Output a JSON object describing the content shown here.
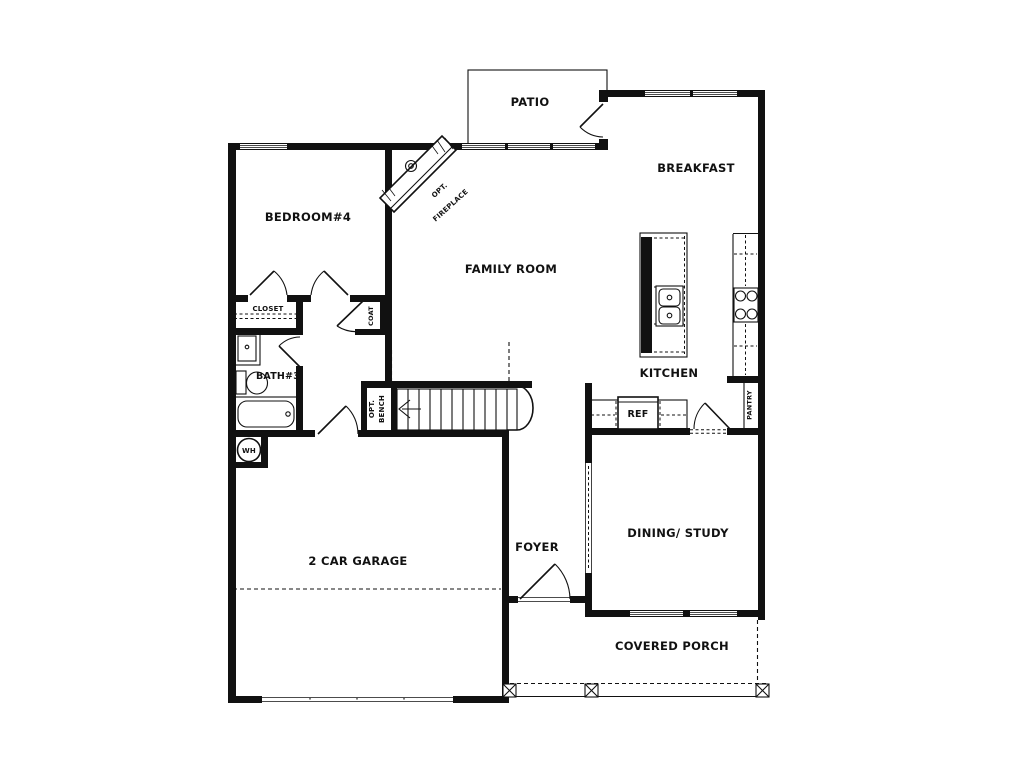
{
  "plan_title": "single-story house floor plan",
  "labels": {
    "patio": "PATIO",
    "breakfast": "BREAKFAST",
    "bedroom4": "BEDROOM#4",
    "family_room": "FAMILY ROOM",
    "kitchen": "KITCHEN",
    "dining_study": "DINING/ STUDY",
    "foyer": "FOYER",
    "garage": "2 CAR GARAGE",
    "covered_porch": "COVERED PORCH",
    "bath3": "BATH#3",
    "closet": "CLOSET",
    "coat": "COAT",
    "pantry": "PANTRY",
    "ref": "REF",
    "water_heater": "WH",
    "opt_bench_line1": "OPT.",
    "opt_bench_line2": "BENCH",
    "opt_fireplace_line1": "OPT.",
    "opt_fireplace_line2": "FIREPLACE"
  },
  "colors": {
    "line": "#111111",
    "background": "#ffffff"
  }
}
